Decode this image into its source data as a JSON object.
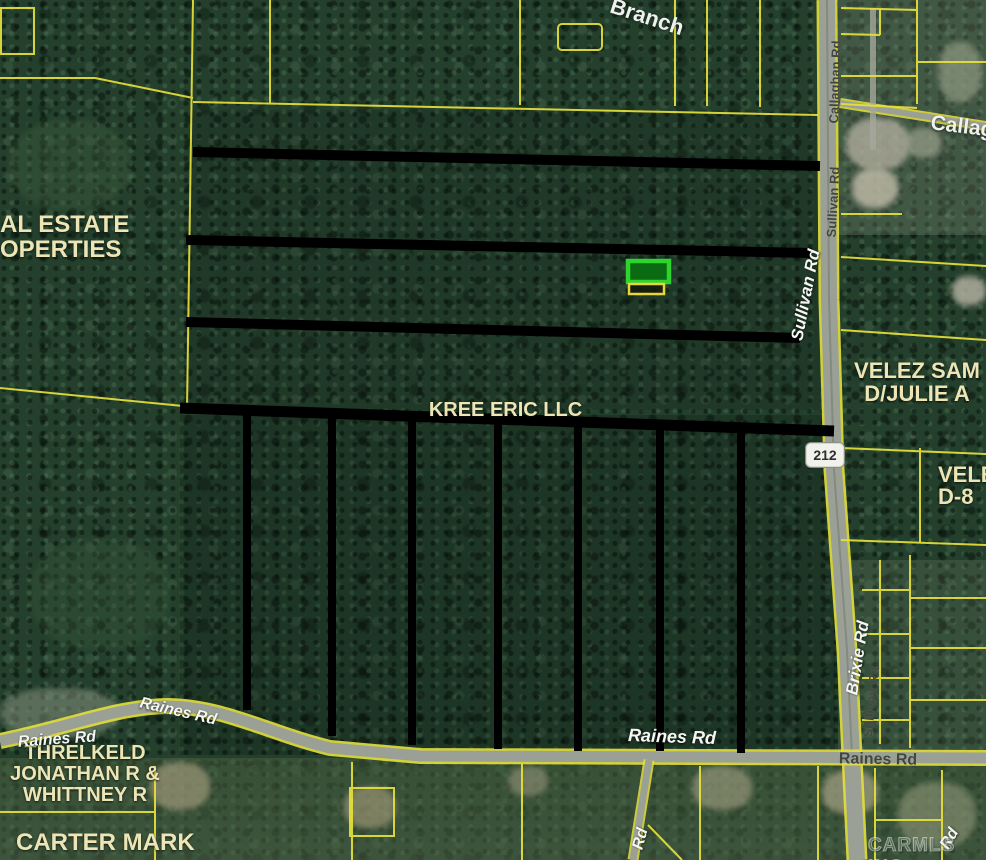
{
  "map": {
    "watermark": "CARMLS INC",
    "route_shield": "212",
    "parcels": {
      "real_estate_line1": "AL ESTATE",
      "real_estate_line2": "OPERTIES",
      "kree": "KREE ERIC LLC",
      "velez_line1": "VELEZ SAM",
      "velez_line2": "D/JULIE A",
      "velez_partial_line1": "VELE",
      "velez_partial_line2": "D-8",
      "threlkeld_line1": "THRELKELD",
      "threlkeld_line2": "JONATHAN R &",
      "threlkeld_line3": "WHITTNEY R",
      "carter": "CARTER MARK"
    },
    "roads": {
      "branch": "Branch",
      "callag_partial": "Callag",
      "callaghan": "Callaghan Rd",
      "sullivan": "Sullivan Rd",
      "raines": "Raines Rd",
      "brixie": "Brixie Rd",
      "rd_partial": "Rd"
    },
    "colors": {
      "parcel_line": "#e6e13b",
      "annotation_line": "#000000",
      "highlight_border": "#2ed32e",
      "highlight_fill": "#0b6b12",
      "secondary_highlight_border": "#e8d53a",
      "parcel_label": "#ede5b5",
      "road_label_light": "#f6f6f4",
      "road_label_dark": "#42463e"
    }
  }
}
